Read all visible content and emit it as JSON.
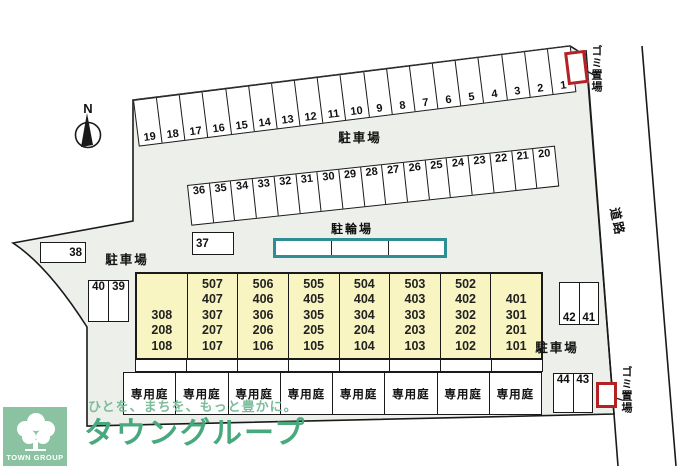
{
  "site": {
    "labels": {
      "parking_top": "駐車場",
      "parking_left": "駐車場",
      "parking_right": "駐車場",
      "bicycle": "駐輪場",
      "road": "道路",
      "garbage_top": "ゴミ置場",
      "garbage_bottom": "ゴミ置場",
      "north": "N"
    },
    "parking_row_top": [
      "19",
      "18",
      "17",
      "16",
      "15",
      "14",
      "13",
      "12",
      "11",
      "10",
      "9",
      "8",
      "7",
      "6",
      "5",
      "4",
      "3",
      "2",
      "1"
    ],
    "parking_row_mid": [
      "36",
      "35",
      "34",
      "33",
      "32",
      "31",
      "30",
      "29",
      "28",
      "27",
      "26",
      "25",
      "24",
      "23",
      "22",
      "21",
      "20"
    ],
    "single_spaces": {
      "s37": "37",
      "s38": "38",
      "s39": "39",
      "s40": "40",
      "s41": "41",
      "s42": "42",
      "s43": "43",
      "s44": "44"
    },
    "building": {
      "columns": [
        [
          "308",
          "208",
          "108"
        ],
        [
          "507",
          "407",
          "307",
          "207",
          "107"
        ],
        [
          "506",
          "406",
          "306",
          "206",
          "106"
        ],
        [
          "505",
          "405",
          "305",
          "205",
          "105"
        ],
        [
          "504",
          "404",
          "304",
          "204",
          "104"
        ],
        [
          "503",
          "403",
          "303",
          "203",
          "103"
        ],
        [
          "502",
          "402",
          "302",
          "202",
          "102"
        ],
        [
          "401",
          "301",
          "201",
          "101"
        ]
      ]
    },
    "garden_cells": [
      "専用庭",
      "専用庭",
      "専用庭",
      "専用庭",
      "専用庭",
      "専用庭",
      "専用庭",
      "専用庭"
    ]
  },
  "colors": {
    "site_fill": "#edefeb",
    "outline": "#1a1a1a",
    "building_fill": "#f9f5c3",
    "garbage_red": "#b52025",
    "bicycle_teal": "#2d8e96",
    "logo_bg_green": "#8ac2a2",
    "brand_green": "#47a97d",
    "slogan_green": "#7cbd9b"
  },
  "logo": {
    "brand_en": "TOWN GROUP",
    "slogan": "ひとを、まちを、もっと豊かに。",
    "brand_jp": "タウングループ"
  }
}
